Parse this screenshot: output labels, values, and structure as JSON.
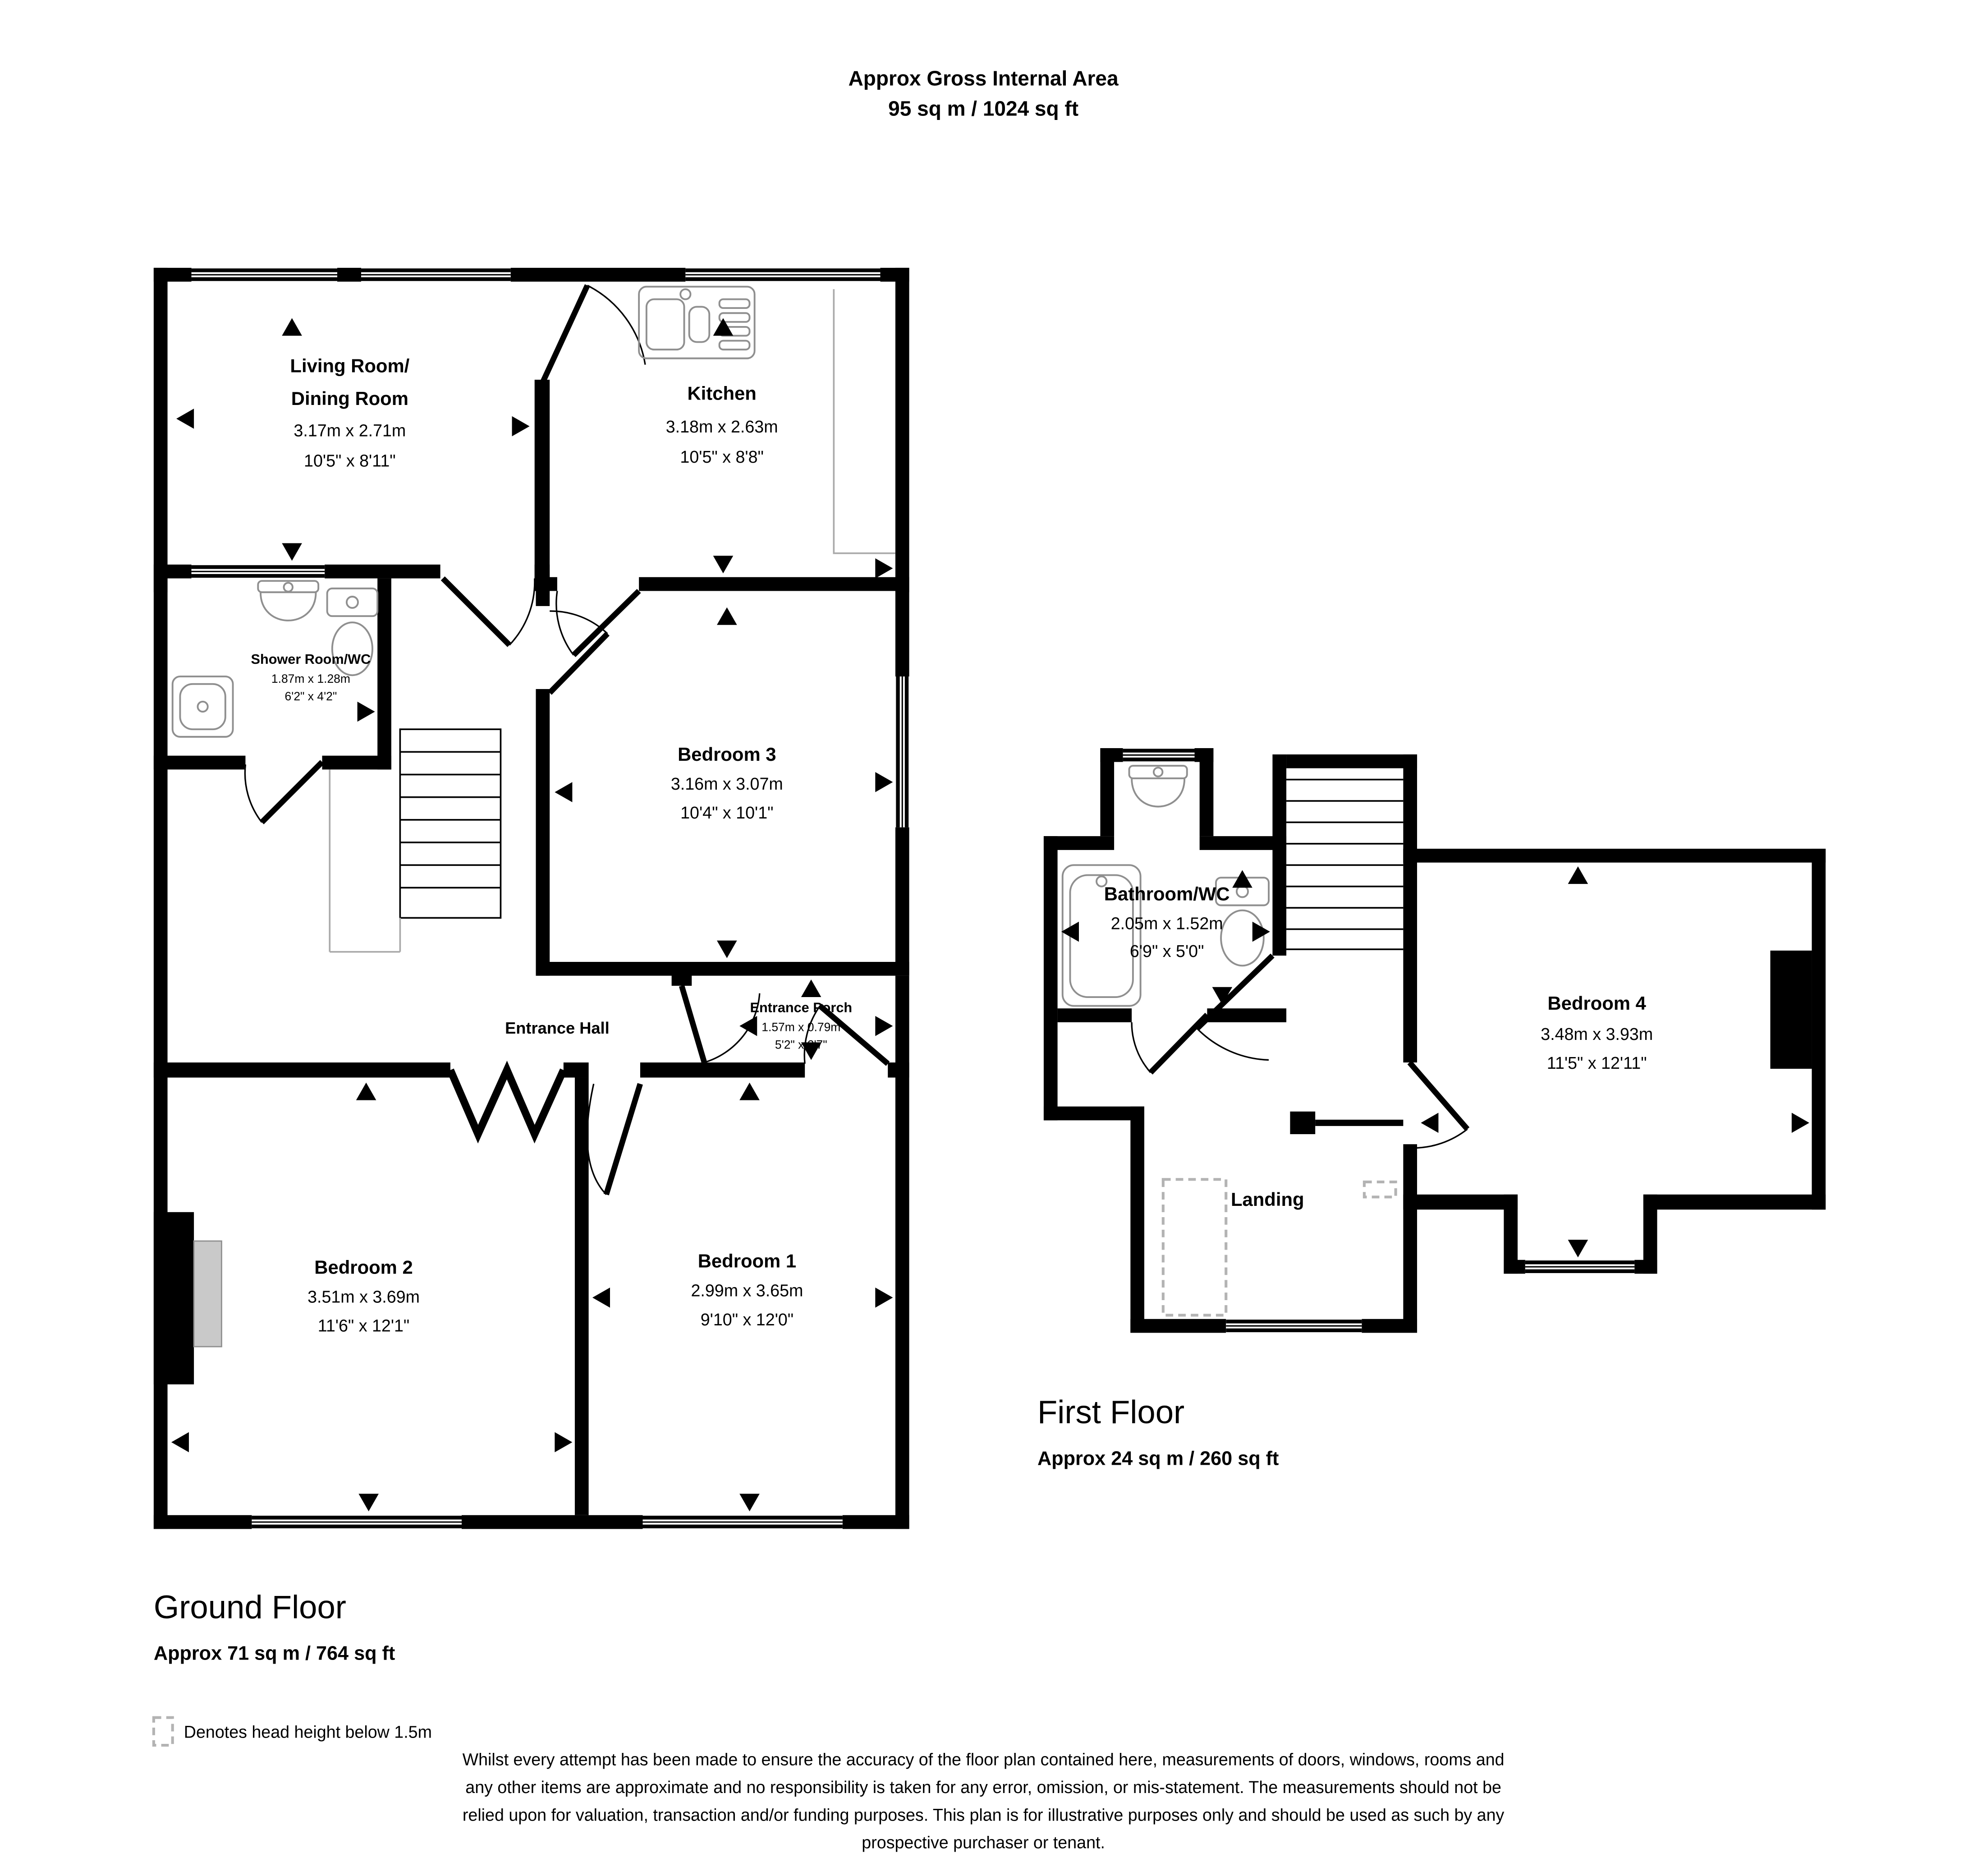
{
  "plan": {
    "header": {
      "line1": "Approx Gross Internal Area",
      "line2": "95 sq m / 1024 sq ft"
    },
    "gf": {
      "heading": "Ground Floor",
      "area": "Approx 71 sq m / 764 sq ft",
      "living": {
        "n1": "Living Room/",
        "n2": "Dining Room",
        "m": "3.17m x 2.71m",
        "i": "10'5\" x 8'11\""
      },
      "kitchen": {
        "n": "Kitchen",
        "m": "3.18m x 2.63m",
        "i": "10'5\" x 8'8\""
      },
      "shower": {
        "n": "Shower Room/WC",
        "m": "1.87m x 1.28m",
        "i": "6'2\" x 4'2\""
      },
      "bed3": {
        "n": "Bedroom 3",
        "m": "3.16m x 3.07m",
        "i": "10'4\" x 10'1\""
      },
      "hall": {
        "n": "Entrance Hall"
      },
      "porch": {
        "n": "Entrance Porch",
        "m": "1.57m x 0.79m",
        "i": "5'2\" x 2'7\""
      },
      "bed2": {
        "n": "Bedroom 2",
        "m": "3.51m x 3.69m",
        "i": "11'6\" x 12'1\""
      },
      "bed1": {
        "n": "Bedroom 1",
        "m": "2.99m x 3.65m",
        "i": "9'10\" x 12'0\""
      }
    },
    "ff": {
      "heading": "First Floor",
      "area": "Approx 24 sq m / 260 sq ft",
      "bathroom": {
        "n": "Bathroom/WC",
        "m": "2.05m x 1.52m",
        "i": "6'9\" x 5'0\""
      },
      "bed4": {
        "n": "Bedroom 4",
        "m": "3.48m x 3.93m",
        "i": "11'5\" x 12'11\""
      },
      "landing": {
        "n": "Landing"
      }
    },
    "legend": {
      "head_height": "Denotes head height below 1.5m"
    },
    "disclaimer": [
      "Whilst every attempt has been made to ensure the accuracy of the floor plan contained here, measurements of doors, windows, rooms and",
      "any other items are approximate and no responsibility is taken for any error, omission, or mis-statement. The measurements should not be",
      "relied upon for valuation, transaction and/or funding purposes. This plan is for illustrative purposes only and should be used as such by any",
      "prospective purchaser or tenant."
    ],
    "colors": {
      "walls": "#000000",
      "fixtures": "#8f8f8f",
      "head_height_dash": "#b3b3b3",
      "bay": "#c9c9c9"
    }
  }
}
